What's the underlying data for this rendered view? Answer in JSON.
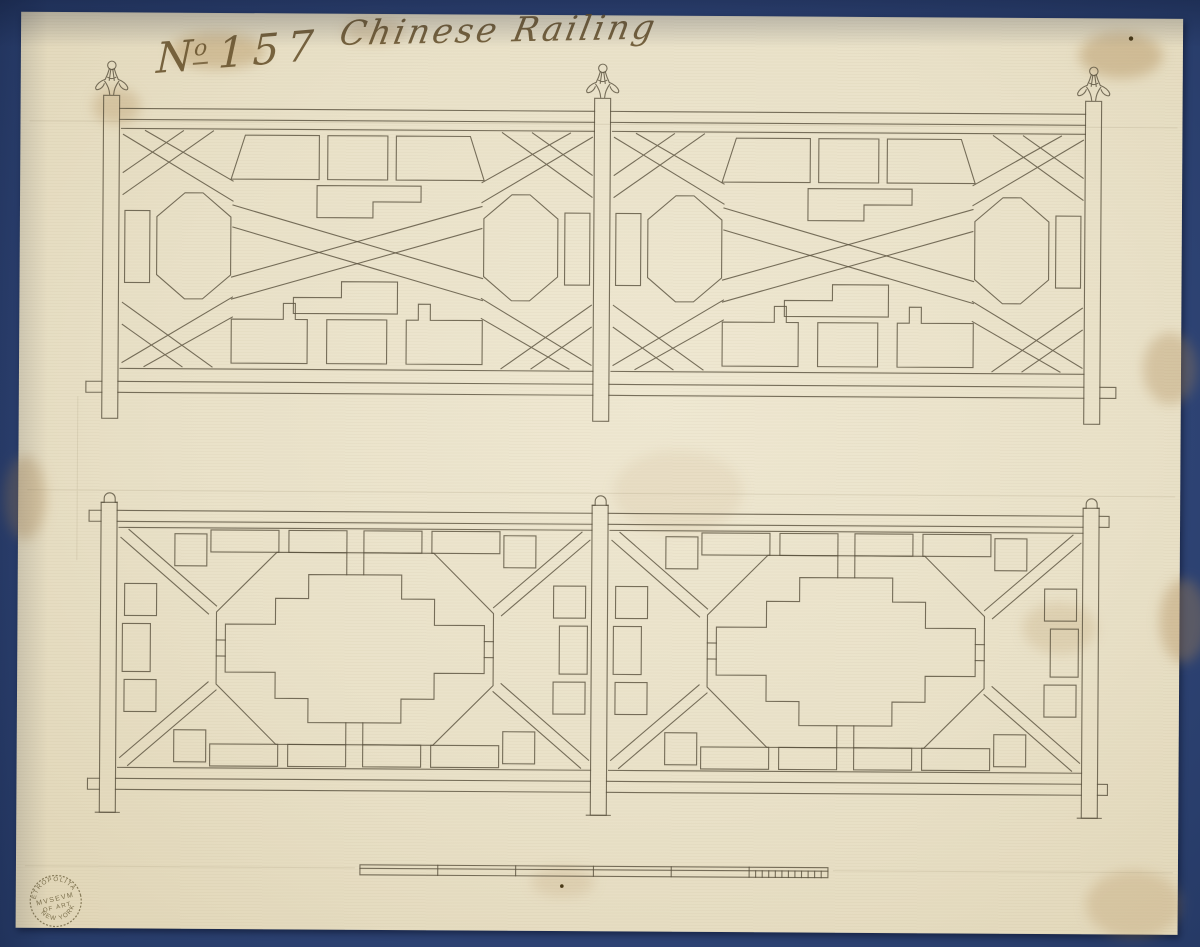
{
  "artwork": {
    "number_inscription": {
      "prefix": "N",
      "superscript": "o",
      "value": "157"
    },
    "title_inscription": "Chinese Railing",
    "stamp": {
      "top": "METROPOLITAN",
      "middle1": "MVSEVM",
      "middle2": "OF ART",
      "bottom": "NEW YORK"
    },
    "colors": {
      "mount_blue": "#31477a",
      "paper_cream": "#e9e1c8",
      "ink_sepia": "#5c5340",
      "handwriting_ink": "#6a5530",
      "stamp_ink": "#6f6340"
    }
  }
}
